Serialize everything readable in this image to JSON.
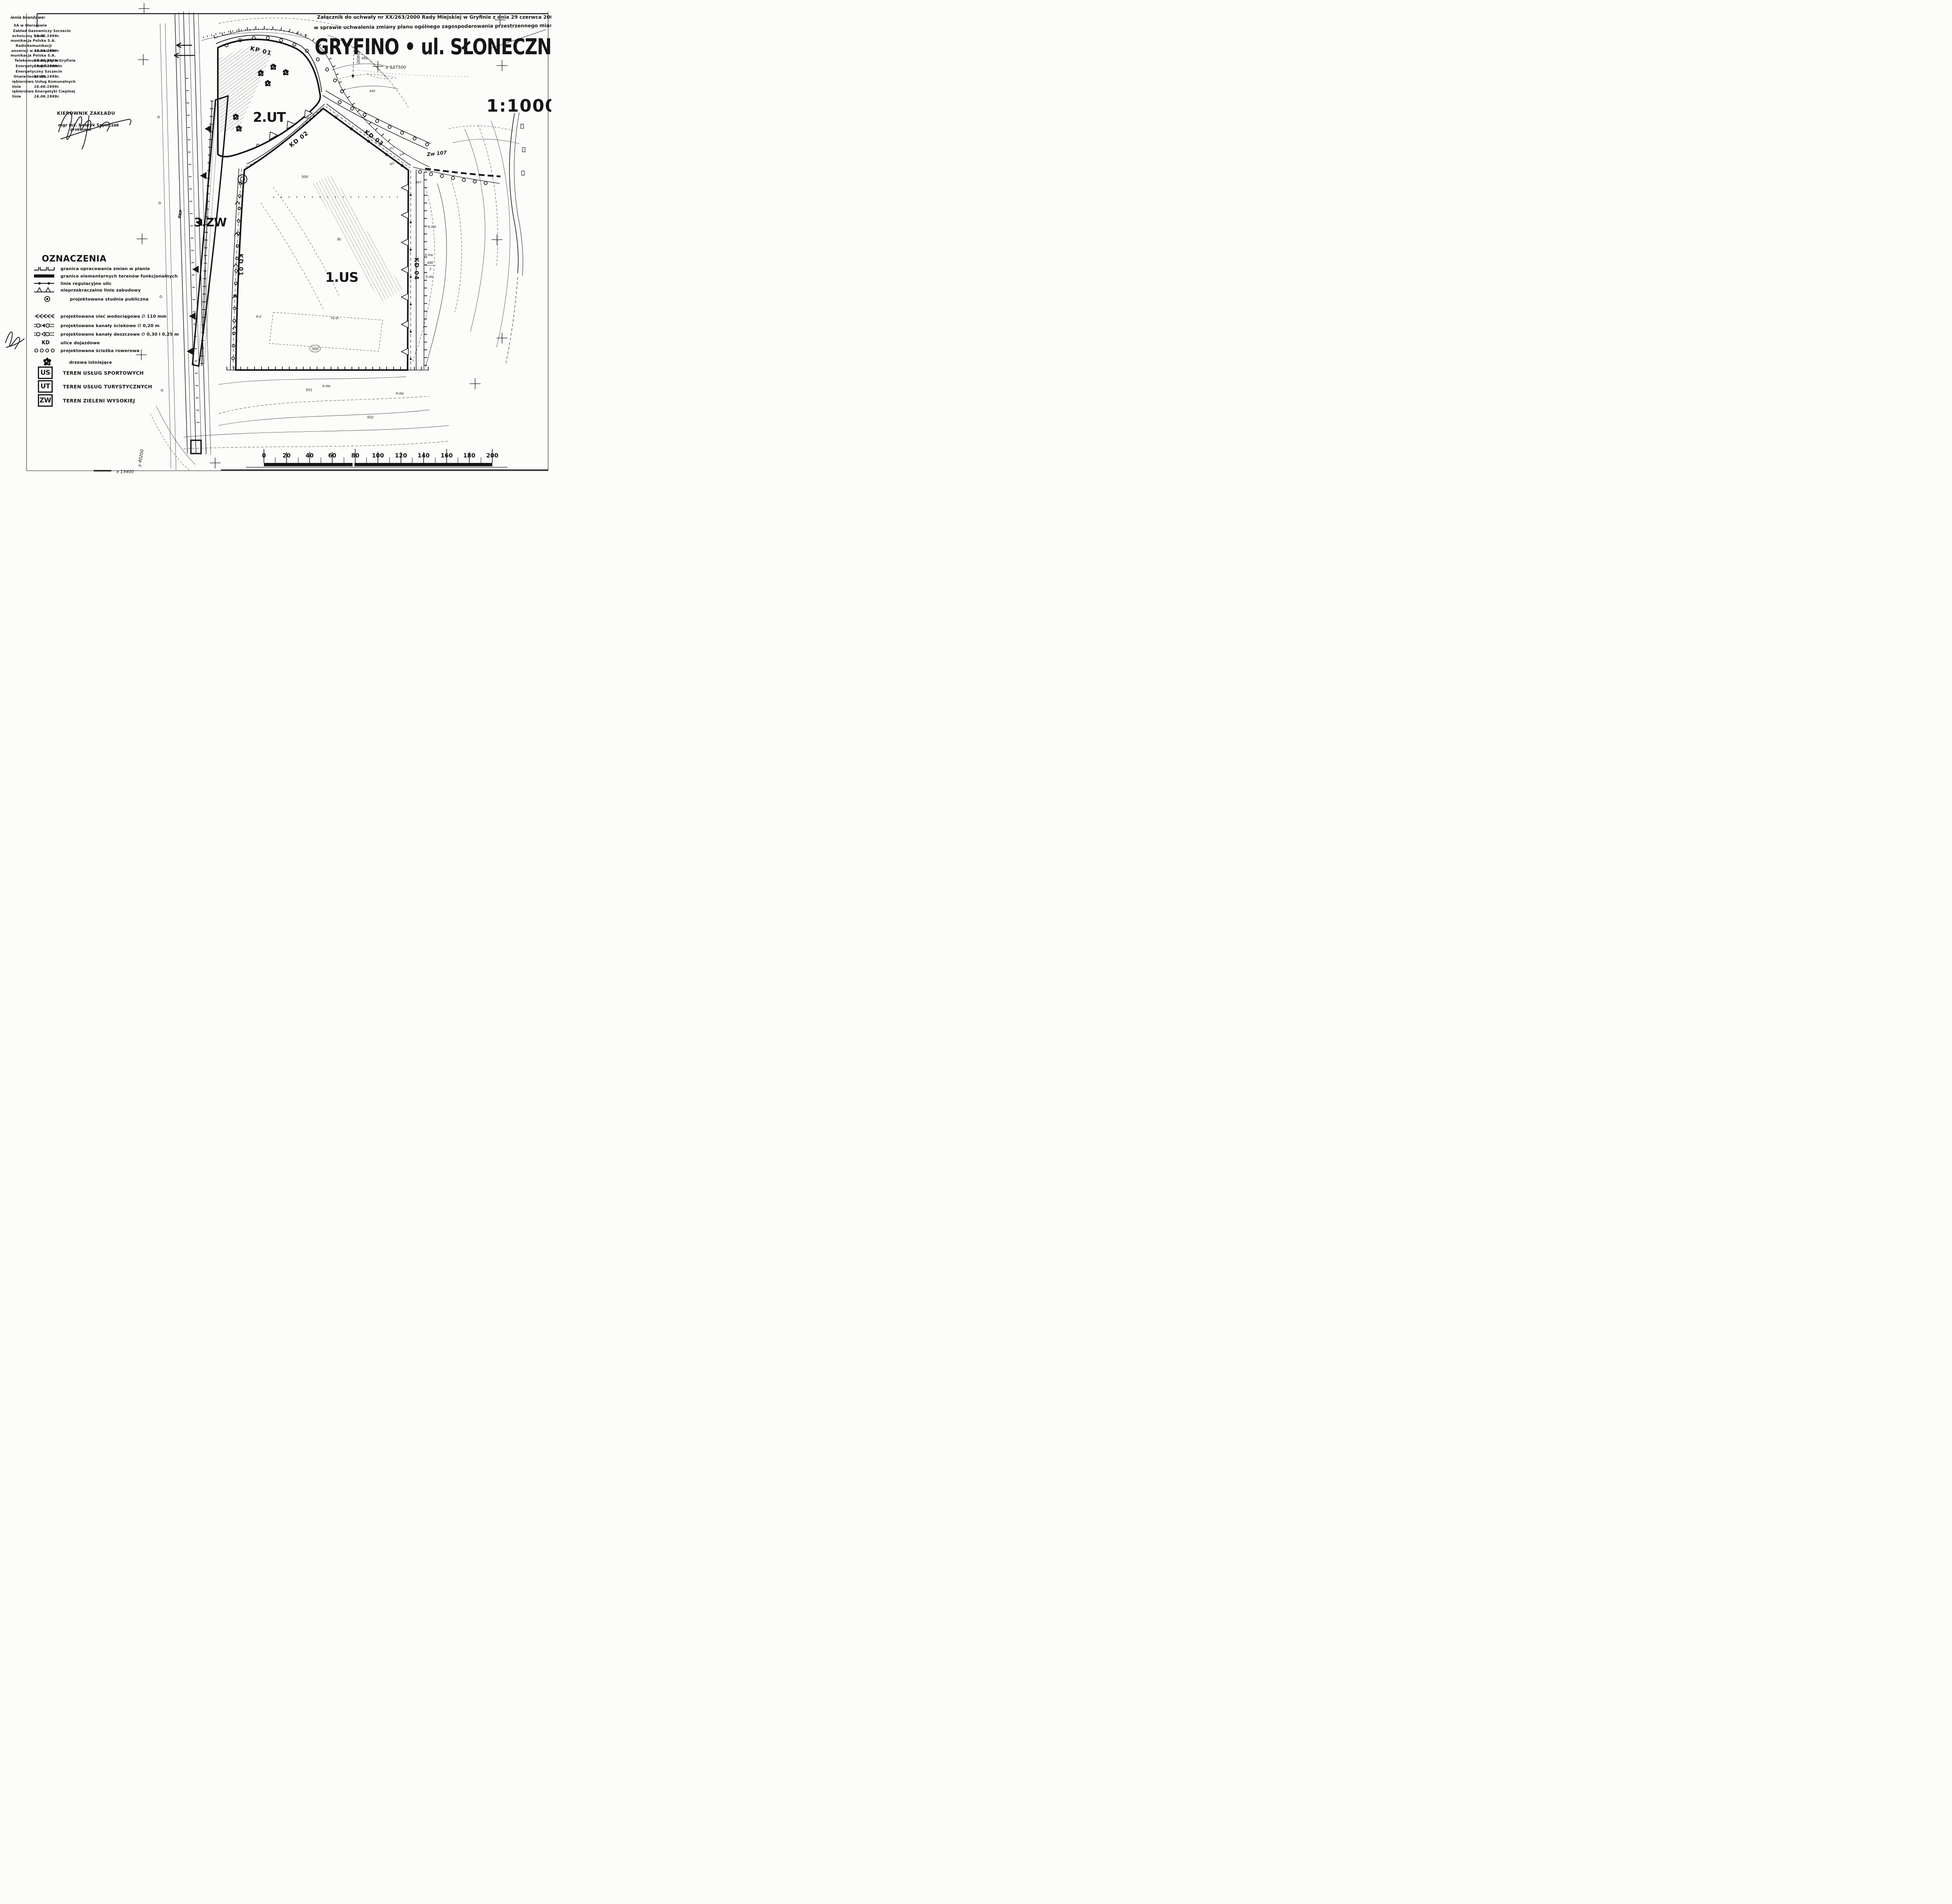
{
  "header": {
    "attachment_line1": "Załącznik do uchwały nr XX/263/2000 Rady Miejskiej w Gryfinie z dnia 29 czerwca 2000 r.",
    "attachment_line2": "w sprawie uchwalenia zmiany planu ogólnego zagospodarowania przestrzennego miasta",
    "title": "GRYFINO • ul. SŁONECZNA",
    "scale": "1:1000"
  },
  "approvals": {
    "heading": "ienia branżowe:",
    "rows": [
      {
        "text": "SA w Warszawie",
        "date": ""
      },
      {
        "text": "Zakład Gazowniczy Szczecin",
        "date": ""
      },
      {
        "text": "echniczny Sieci",
        "date": "14.06.1999r."
      },
      {
        "text": "munikacja Polska S.A.",
        "date": ""
      },
      {
        "text": "Radiokomunikacji",
        "date": ""
      },
      {
        "text": "ansmisji w Szczecinie",
        "date": "15.06.1999r."
      },
      {
        "text": "munikacja Polska S.A.",
        "date": ""
      },
      {
        "text": "Telekomunikacyjny w Gryfinie",
        "date": "16.06.1999r."
      },
      {
        "text": "Energetyczny Szczecin",
        "date": "15.06.1999r."
      },
      {
        "text": "Energetyczny Szczecin",
        "date": ""
      },
      {
        "text": "Oświetlenia Ulic",
        "date": "15.06.1999r."
      },
      {
        "text": "iębiorstwo Usług Komunalnych",
        "date": ""
      },
      {
        "text": "linie",
        "date": "16.06.1999r."
      },
      {
        "text": "iębiorstwo Energetyki Cieplnej",
        "date": ""
      },
      {
        "text": "linie",
        "date": "16.06.1999r."
      }
    ]
  },
  "signature": {
    "heading": "KIEROWNIK ZAKŁADU",
    "name": "mgr inż. Henryk Szymczak",
    "role": "prokurent"
  },
  "legend": {
    "title": "OZNACZENIA",
    "items": [
      {
        "label": "granica opracowania zmian w planie"
      },
      {
        "label": "granice elementarnych terenów funkcjonalnych"
      },
      {
        "label": "linie regulacyjne ulic"
      },
      {
        "label": "nieprzekraczalne linie zabudowy"
      },
      {
        "label": "projektowana studnia publiczna"
      },
      {
        "label": "projektowana sieć wodociągowa ∅ 110 mm"
      },
      {
        "label": "projektowane kanały ściekowe ∅ 0,20 m"
      },
      {
        "label": "projektowane kanały deszczowe ∅ 0,30 i 0,25 m"
      },
      {
        "symbol_text": "KD",
        "label": "ulice dojazdowe"
      },
      {
        "label": "projektowana ścieżka rowerowa"
      },
      {
        "label": "drzewa istniejące"
      }
    ],
    "zones": [
      {
        "code": "US",
        "label": "TEREN USŁUG SPORTOWYCH"
      },
      {
        "code": "UT",
        "label": "TEREN USŁUG TURYSTYCZNYCH"
      },
      {
        "code": "ZW",
        "label": "TEREN ZIELENI WYSOKIEJ"
      }
    ]
  },
  "map": {
    "zone_labels": {
      "z1": "1.US",
      "z2": "2.UT",
      "z3": "3.ZW"
    },
    "road_labels": {
      "kp01": "KP 01",
      "kd01": "KD 01",
      "kd02": "KD 02",
      "kd03": "KD 03",
      "kd04": "KD 04"
    },
    "coord_labels": {
      "x137500": "x 137500",
      "x13400": "x 13400",
      "y40200": "y 40200",
      "y40400": "40400"
    },
    "misc_labels": {
      "pkp": "PKP",
      "zw107": "Zw 107",
      "p500": "500",
      "p500b": "500",
      "p501": "501",
      "p502": "502",
      "r4a": "R-IVa",
      "r4b": "R-IVb",
      "r3b": "R-IIIb",
      "r3b2": "R-IIIb",
      "r3b3": "R-IIIb",
      "f498": "498",
      "f498d": "2",
      "bc": "Bc",
      "psvi": "Ps-VI",
      "rv": "R-V",
      "e353": "353",
      "e349": "349",
      "e365": "365",
      "c460": "460",
      "c460b": "460",
      "c497": "497"
    }
  },
  "scalebar": {
    "labels": [
      "0",
      "20",
      "40",
      "60",
      "80",
      "100",
      "120",
      "140",
      "160",
      "180",
      "200"
    ]
  },
  "colors": {
    "ink": "#161616",
    "paper": "#fcfcfa"
  }
}
